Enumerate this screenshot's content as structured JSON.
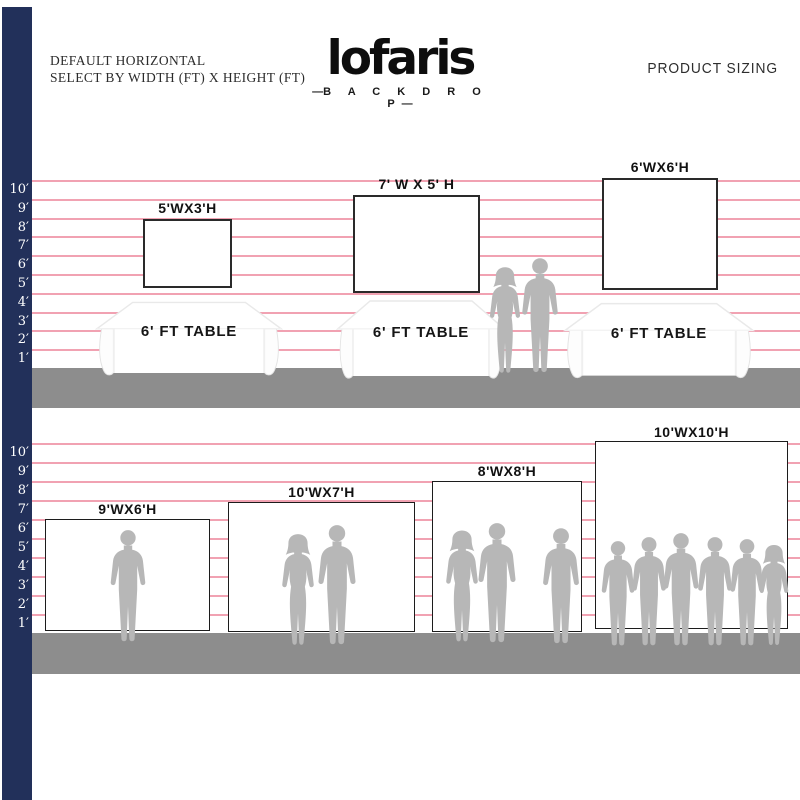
{
  "header": {
    "title_line1": "DEFAULT HORIZONTAL",
    "title_line2": "SELECT BY WIDTH (FT) X HEIGHT (FT)",
    "logo_name": "lofaris",
    "logo_dash": "—",
    "logo_subtitle": "B A C K D R O P",
    "right_label": "PRODUCT SIZING"
  },
  "ruler": {
    "labels": [
      "10′",
      "9′",
      "8′",
      "7′",
      "6′",
      "5′",
      "4′",
      "3′",
      "2′",
      "1′"
    ]
  },
  "top_section": {
    "backdrops": [
      {
        "label": "5'WX3'H"
      },
      {
        "label": "7' W X 5' H"
      },
      {
        "label": "6'WX6'H"
      }
    ],
    "table_label": "6' FT TABLE"
  },
  "bottom_section": {
    "backdrops": [
      {
        "label": "9'WX6'H"
      },
      {
        "label": "10'WX7'H"
      },
      {
        "label": "8'WX8'H"
      },
      {
        "label": "10'WX10'H"
      }
    ]
  },
  "colors": {
    "ruler_bar": "#22305a",
    "grid_line": "#f1a2b2",
    "floor": "#8d8d8d",
    "silhouette": "#b7b7b7",
    "backdrop_border": "#1c1c1c"
  }
}
